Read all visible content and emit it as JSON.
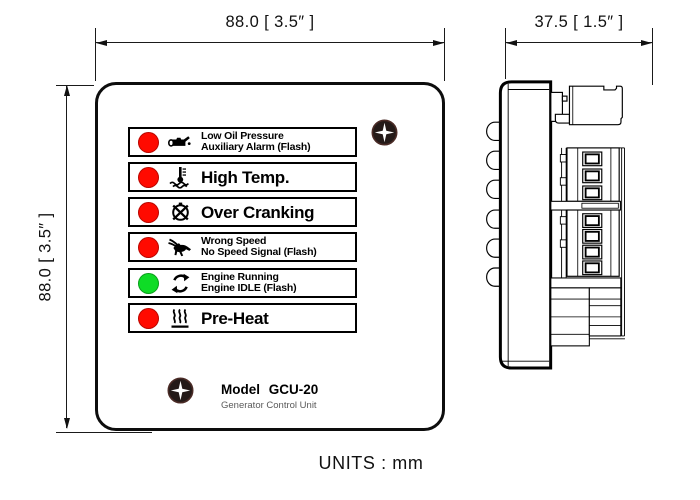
{
  "dimensions": {
    "front_width": "88.0 [ 3.5″ ]",
    "front_height": "88.0 [ 3.5″ ]",
    "side_depth": "37.5 [ 1.5″ ]"
  },
  "front_panel": {
    "indicators": [
      {
        "led_color": "#ff0a00",
        "icon": "low-oil-pressure-icon",
        "line1": "Low Oil Pressure",
        "line2": "Auxiliary Alarm (Flash)"
      },
      {
        "led_color": "#ff0a00",
        "icon": "high-temp-icon",
        "line1": "High Temp.",
        "line2": ""
      },
      {
        "led_color": "#ff0a00",
        "icon": "over-cranking-icon",
        "line1": "Over Cranking",
        "line2": ""
      },
      {
        "led_color": "#ff0a00",
        "icon": "wrong-speed-icon",
        "line1": "Wrong Speed",
        "line2": "No Speed Signal (Flash)"
      },
      {
        "led_color": "#0fdc26",
        "icon": "engine-running-icon",
        "line1": "Engine Running",
        "line2": "Engine IDLE (Flash)"
      },
      {
        "led_color": "#ff0a00",
        "icon": "pre-heat-icon",
        "line1": "Pre-Heat",
        "line2": ""
      }
    ],
    "model_label": "Model  GCU-20",
    "model_subtitle": "Generator Control Unit"
  },
  "footer": {
    "units_label": "UNITS : mm"
  },
  "colors": {
    "led_red": "#ff0a00",
    "led_green": "#0fdc26",
    "line_black": "#000000",
    "subtitle_gray": "#5a5a5a"
  }
}
